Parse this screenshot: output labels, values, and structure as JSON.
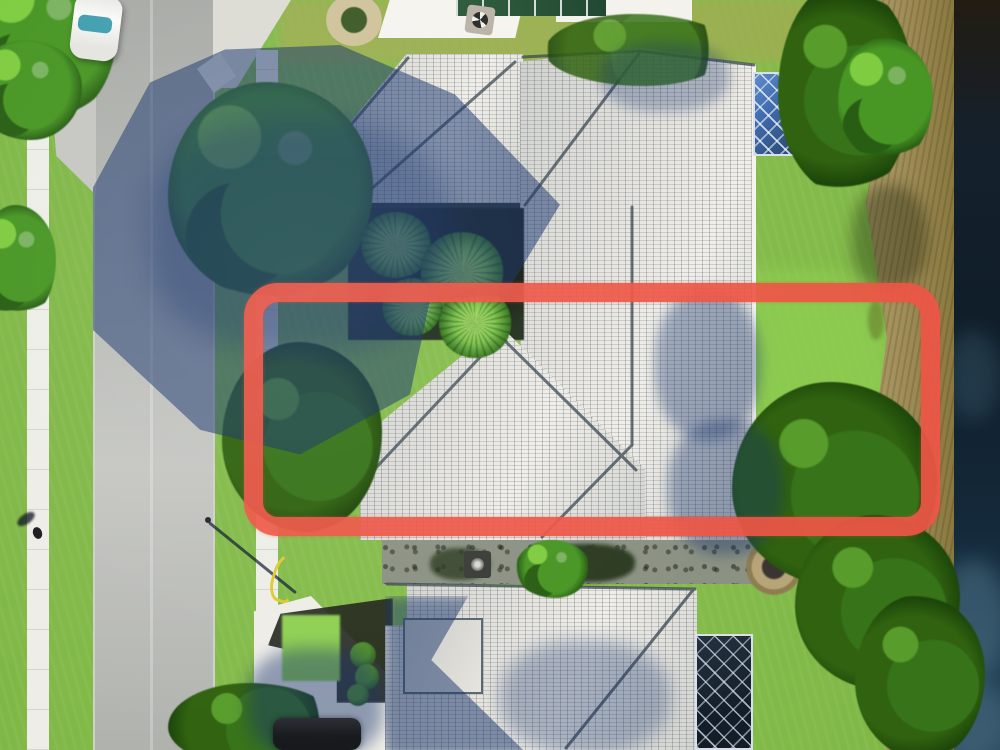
{
  "scene": {
    "kind": "aerial-drone-photograph",
    "description": "Top-down drone photo of a suburban Florida-style neighborhood: a street with sidewalks on the left, a large gray-tile-roof home in the center with a courtyard of palms and a blue screened pool enclosure, a second tile-roof home at the bottom with a dark screened lanai, mature trees, a grassy backyard, and a brown canal bank with dark water along the right edge.",
    "visible_text": [],
    "annotation": {
      "name": "property-boundary-annotation",
      "shape": "rounded-rectangle",
      "color": "#ee5646",
      "x": 244,
      "y": 283,
      "width": 696,
      "height": 253,
      "stroke_px": 19,
      "purpose": "highlights the rear lot area of the center property from the house to the canal bank"
    },
    "objects": [
      "street",
      "left-sidewalk",
      "right-sidewalk",
      "white-car",
      "dark-parked-car",
      "pedestrian",
      "street-light-pole",
      "main-house-roof",
      "courtyard-palms",
      "main-pool-enclosure",
      "bottom-house-roof",
      "bottom-pool-enclosure",
      "north-neighbor-roof",
      "solar-panels",
      "fountain-equipment",
      "paver-planter",
      "fire-pit",
      "driveway",
      "mulch-beds",
      "garden-hose",
      "large-trees",
      "hedge-row",
      "canal-bank",
      "canal-water",
      "tree-shadows"
    ]
  },
  "colors": {
    "grass_base": "#7fb746",
    "grass_bright": "#8fd052",
    "grass_sunlit": "#9fae52",
    "street_gray": "#b5b7b3",
    "street_light": "#c6c7c3",
    "sidewalk_white": "#eeede7",
    "concrete": "#dcdbd4",
    "roof_light": "#e9e7e1",
    "roof_mid": "#cfd0cd",
    "ridge_dark": "#39454f",
    "eave_dark": "#2c342c",
    "shadow_navy": "#16336b",
    "tree_green": "#4f9330",
    "tree_light": "#86c94f",
    "tree_dark": "#2d5c1b",
    "palm_green": "#7cc24a",
    "courtyard_dark": "#22301f",
    "water_top": "#221c12",
    "water_mid": "#0f1e2a",
    "water_haze": "#4b7086",
    "bank_tan": "#a3905a",
    "mulch_dark": "#22241b",
    "gravel": "#8d9086",
    "cage_blue": "#3f6cae",
    "cage_dark": "#131d27",
    "cage_grid": "#d9e0ea",
    "annotation_red": "#ee5646",
    "car_white": "#fbfbf9",
    "car_black": "#16181c",
    "windshield_teal": "#2e96a8",
    "hose_yellow": "#decb2e",
    "firepit_stone": "#b7a478"
  }
}
